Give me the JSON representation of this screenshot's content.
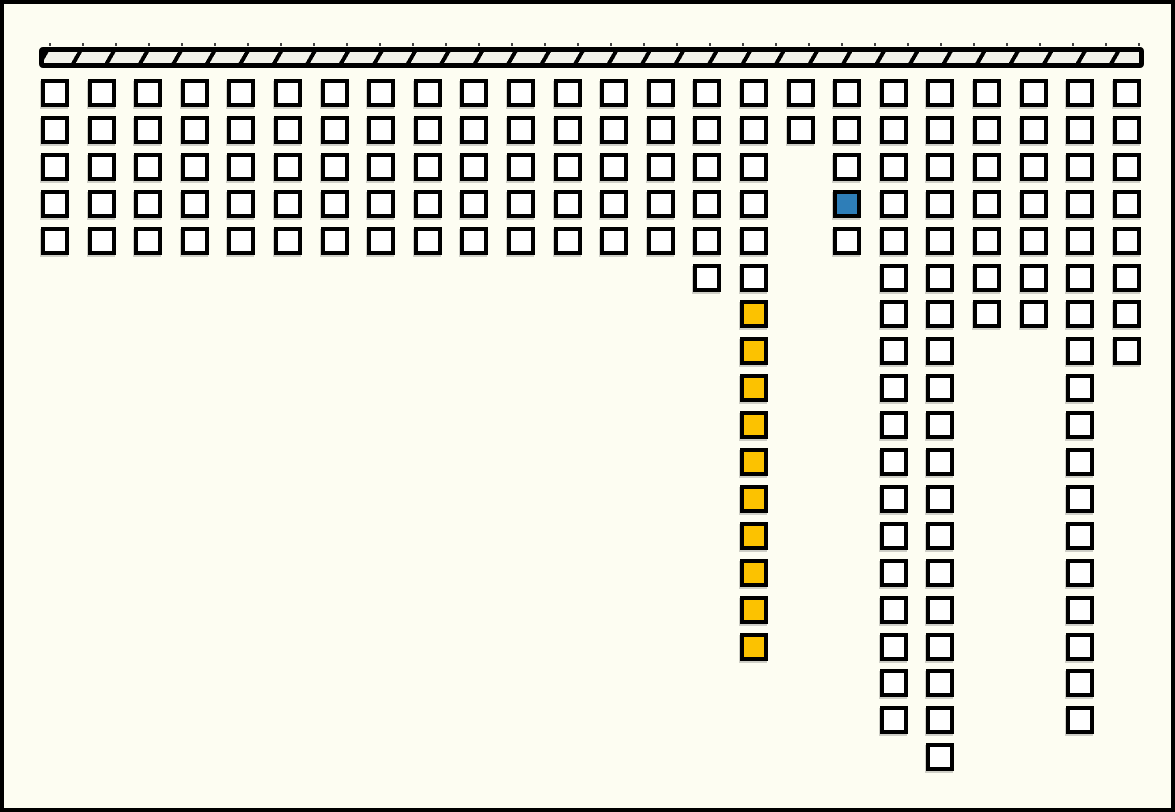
{
  "diagram": {
    "description": "hatched ceiling bar with hanging columns of outlined squares",
    "canvas": {
      "width": 1175,
      "height": 812,
      "background": "#FDFDF2",
      "border_color": "#000000",
      "border_width": 4
    },
    "ceiling_bar": {
      "x": 35,
      "y": 43,
      "width": 1105,
      "height": 21,
      "fill": "#F2F2EA",
      "border_color": "#000000",
      "border_width": 5,
      "corner_radius": 4,
      "hatch_spacing_px": 33,
      "hatch_thickness_px": 4,
      "hatch_angle_deg": 120,
      "hatch_color": "#000000",
      "tick_row_y": 39,
      "tick_size_px": 2,
      "tick_color": "#444444"
    },
    "grid": {
      "origin_x": 37,
      "origin_y": 75,
      "col_pitch": 46.6,
      "row_pitch": 36.9,
      "square_size": 28,
      "square_border_width": 4,
      "square_border_color": "#000000",
      "total_columns": 24,
      "total_squares": 176
    },
    "colors": {
      "white": "#FFFFFF",
      "blue": "#2E7EB8",
      "yellow": "#FCC200"
    },
    "columns": [
      {
        "rows": 5
      },
      {
        "rows": 5
      },
      {
        "rows": 5
      },
      {
        "rows": 5
      },
      {
        "rows": 5
      },
      {
        "rows": 5
      },
      {
        "rows": 5
      },
      {
        "rows": 5
      },
      {
        "rows": 5
      },
      {
        "rows": 5
      },
      {
        "rows": 5
      },
      {
        "rows": 5
      },
      {
        "rows": 5
      },
      {
        "rows": 5
      },
      {
        "rows": 6
      },
      {
        "rows": 16,
        "colored": {
          "from": 7,
          "to": 16,
          "color": "yellow"
        }
      },
      {
        "rows": 2
      },
      {
        "rows": 5,
        "colored": {
          "from": 4,
          "to": 4,
          "color": "blue"
        }
      },
      {
        "rows": 18
      },
      {
        "rows": 19
      },
      {
        "rows": 7
      },
      {
        "rows": 7
      },
      {
        "rows": 18
      },
      {
        "rows": 8
      }
    ]
  }
}
